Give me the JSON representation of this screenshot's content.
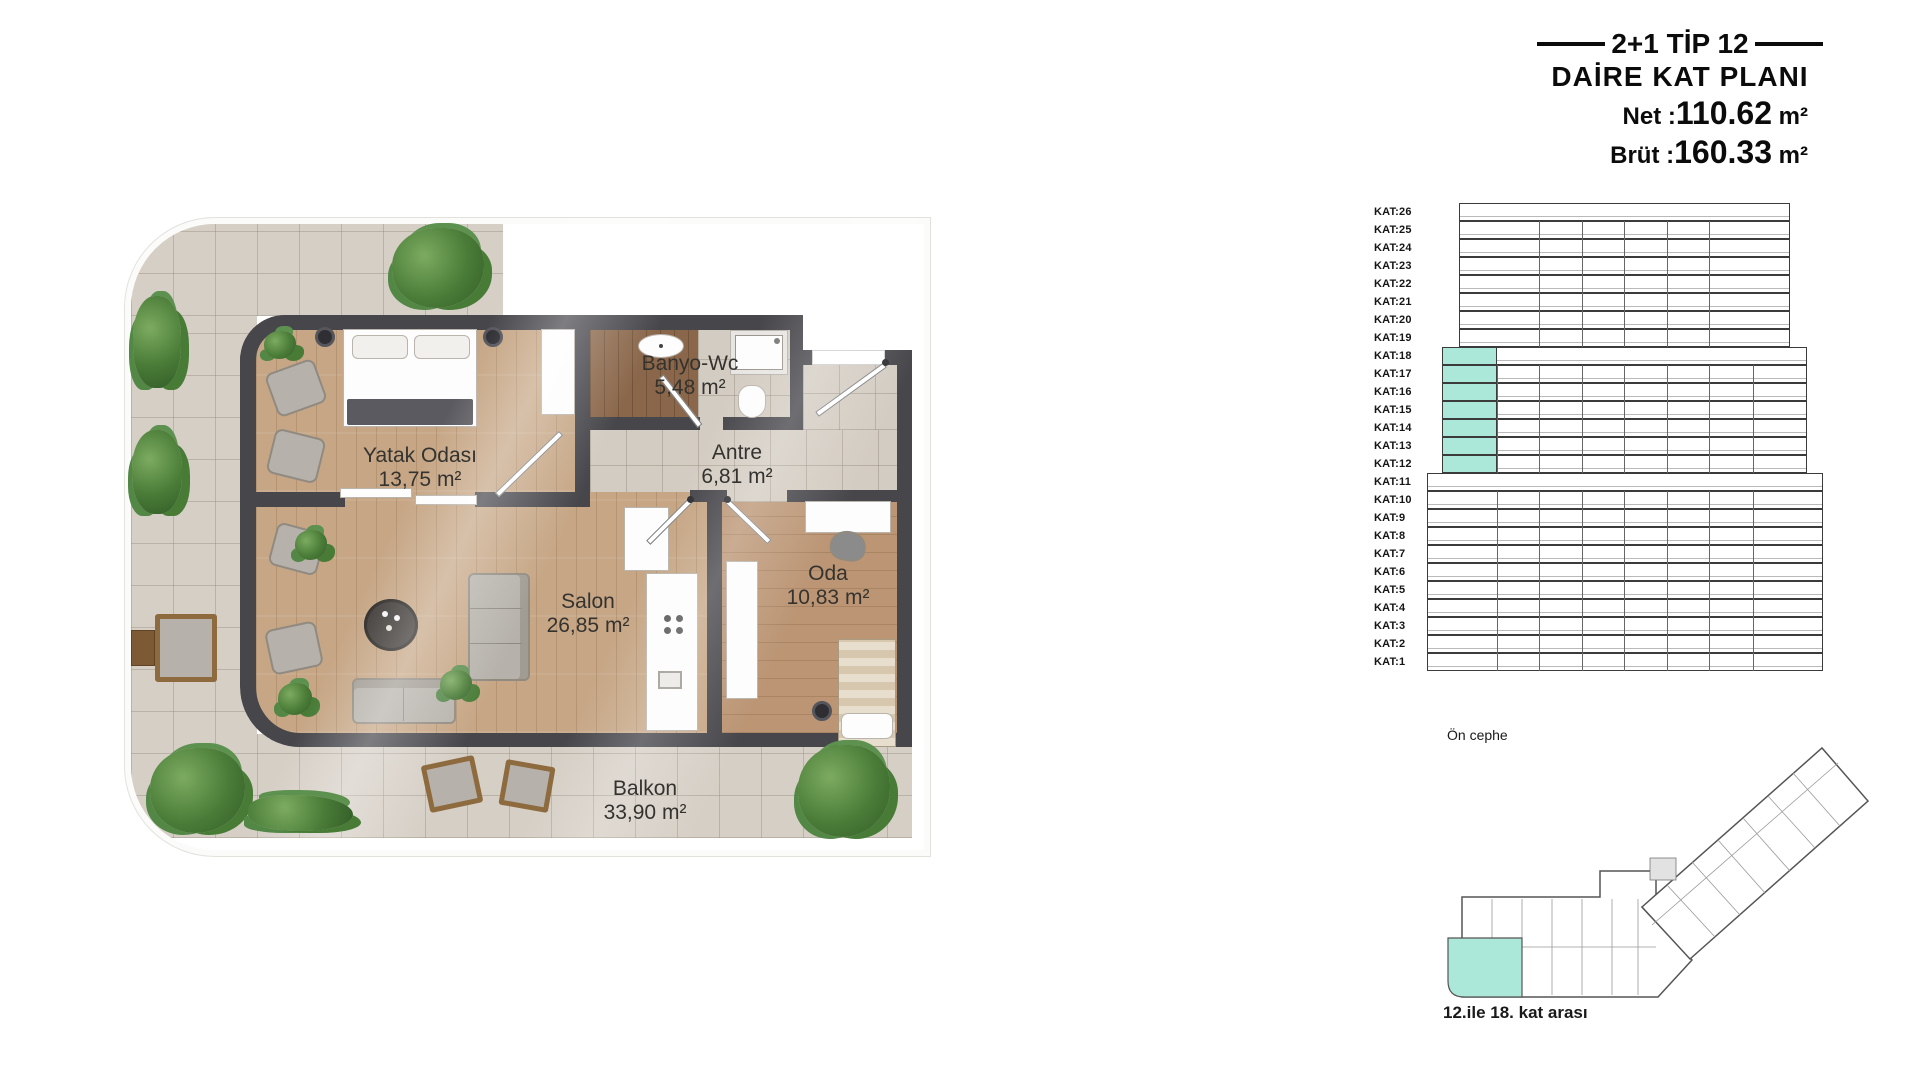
{
  "title_block": {
    "line1": "2+1 TİP 12",
    "line2": "DAİRE KAT PLANI",
    "net_label": "Net :",
    "net_value": "110.62",
    "net_unit": "m²",
    "brut_label": "Brüt :",
    "brut_value": "160.33",
    "brut_unit": "m²"
  },
  "floor_plan": {
    "rooms": [
      {
        "name": "Yatak Odası",
        "area": "13,75 m²"
      },
      {
        "name": "Banyo-Wc",
        "area": "5,48 m²"
      },
      {
        "name": "Antre",
        "area": "6,81 m²"
      },
      {
        "name": "Salon",
        "area": "26,85 m²"
      },
      {
        "name": "Oda",
        "area": "10,83 m²"
      },
      {
        "name": "Balkon",
        "area": "33,90 m²"
      }
    ]
  },
  "elevation": {
    "floors": [
      "KAT:26",
      "KAT:25",
      "KAT:24",
      "KAT:23",
      "KAT:22",
      "KAT:21",
      "KAT:20",
      "KAT:19",
      "KAT:18",
      "KAT:17",
      "KAT:16",
      "KAT:15",
      "KAT:14",
      "KAT:13",
      "KAT:12",
      "KAT:11",
      "KAT:10",
      "KAT:9",
      "KAT:8",
      "KAT:7",
      "KAT:6",
      "KAT:5",
      "KAT:4",
      "KAT:3",
      "KAT:2",
      "KAT:1"
    ],
    "highlighted_floors": [
      "KAT:18",
      "KAT:17",
      "KAT:16",
      "KAT:15",
      "KAT:14",
      "KAT:13",
      "KAT:12"
    ],
    "caption": "Ön cephe",
    "highlight_color": "#ace8da"
  },
  "site_plan": {
    "caption": "12.ile 18. kat arası",
    "highlight_color": "#ace8da"
  }
}
